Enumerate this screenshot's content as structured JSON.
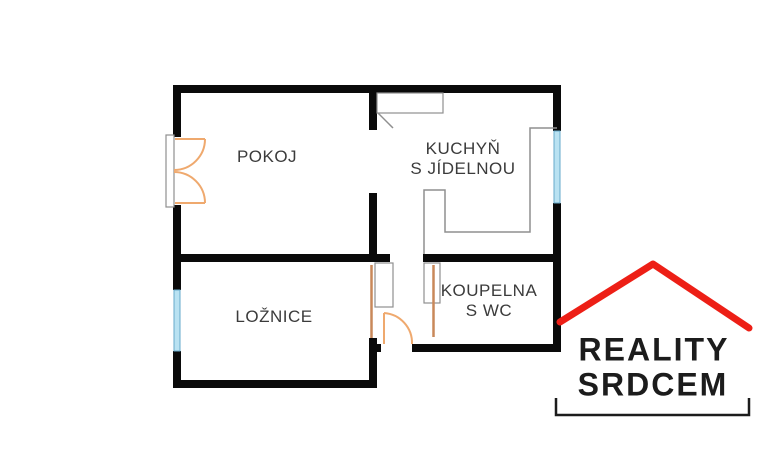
{
  "floorplan": {
    "rooms": {
      "pokoj": {
        "label": "POKOJ"
      },
      "kuchyn": {
        "line1": "KUCHYŇ",
        "line2": "S JÍDELNOU"
      },
      "loznice": {
        "label": "LOŽNICE"
      },
      "koupelna": {
        "line1": "KOUPELNA",
        "line2": "S WC"
      }
    }
  },
  "logo": {
    "line1": "REALITY",
    "line2": "SRDCEM"
  },
  "colors": {
    "wall": "#0a0a0a",
    "fixture_outline": "#8f8f8f",
    "door_accent": "#efa96e",
    "door_panel": "#c9885a",
    "window_glass": "#b9e2f2",
    "window_frame": "#66aacb",
    "label_text": "#3b3b3b",
    "logo_red": "#ed1f16",
    "logo_text": "#1c1c1c"
  }
}
